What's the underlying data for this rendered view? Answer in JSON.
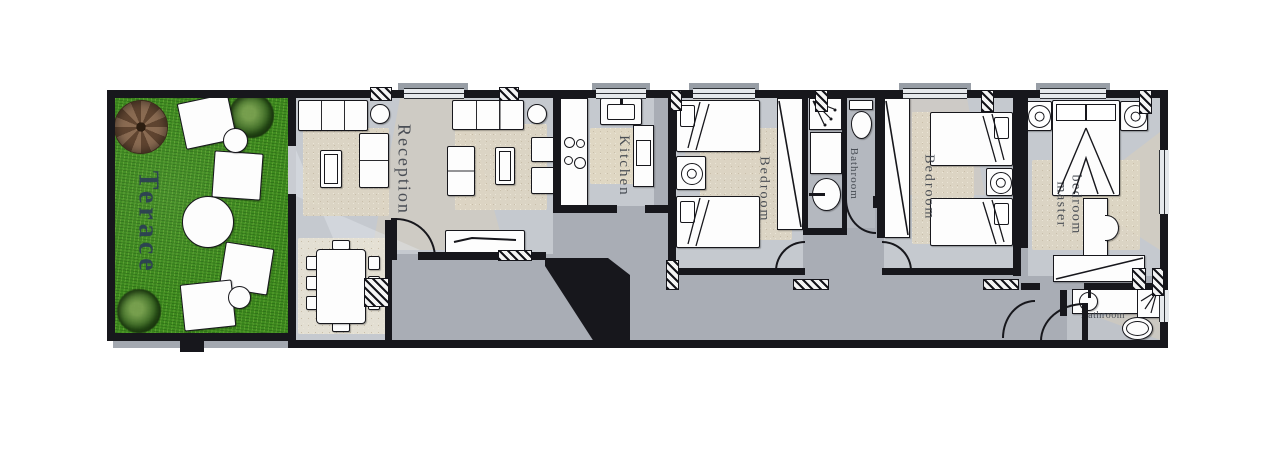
{
  "rooms": {
    "terrace": {
      "label": "Terace"
    },
    "reception": {
      "label": "Reception"
    },
    "kitchen": {
      "label": "Kitchen"
    },
    "bedroom1": {
      "label": "Bedroom"
    },
    "bathroom1": {
      "label": "Bathroom"
    },
    "bedroom2": {
      "label": "Bedroom"
    },
    "master": {
      "label": "master bedroom",
      "lines": [
        "bedroom",
        "master"
      ]
    },
    "bathroom2": {
      "label": "Bathroom"
    }
  },
  "colors": {
    "wall": "#17171c",
    "corridor": "#a9adb5",
    "room": "#c5c9cf",
    "grass": "#3e8b1f",
    "rug": "#ded6c3",
    "lightCone": "#d8cdb9",
    "labelNavy": "#2c3e55",
    "labelDark": "#3f444c"
  }
}
